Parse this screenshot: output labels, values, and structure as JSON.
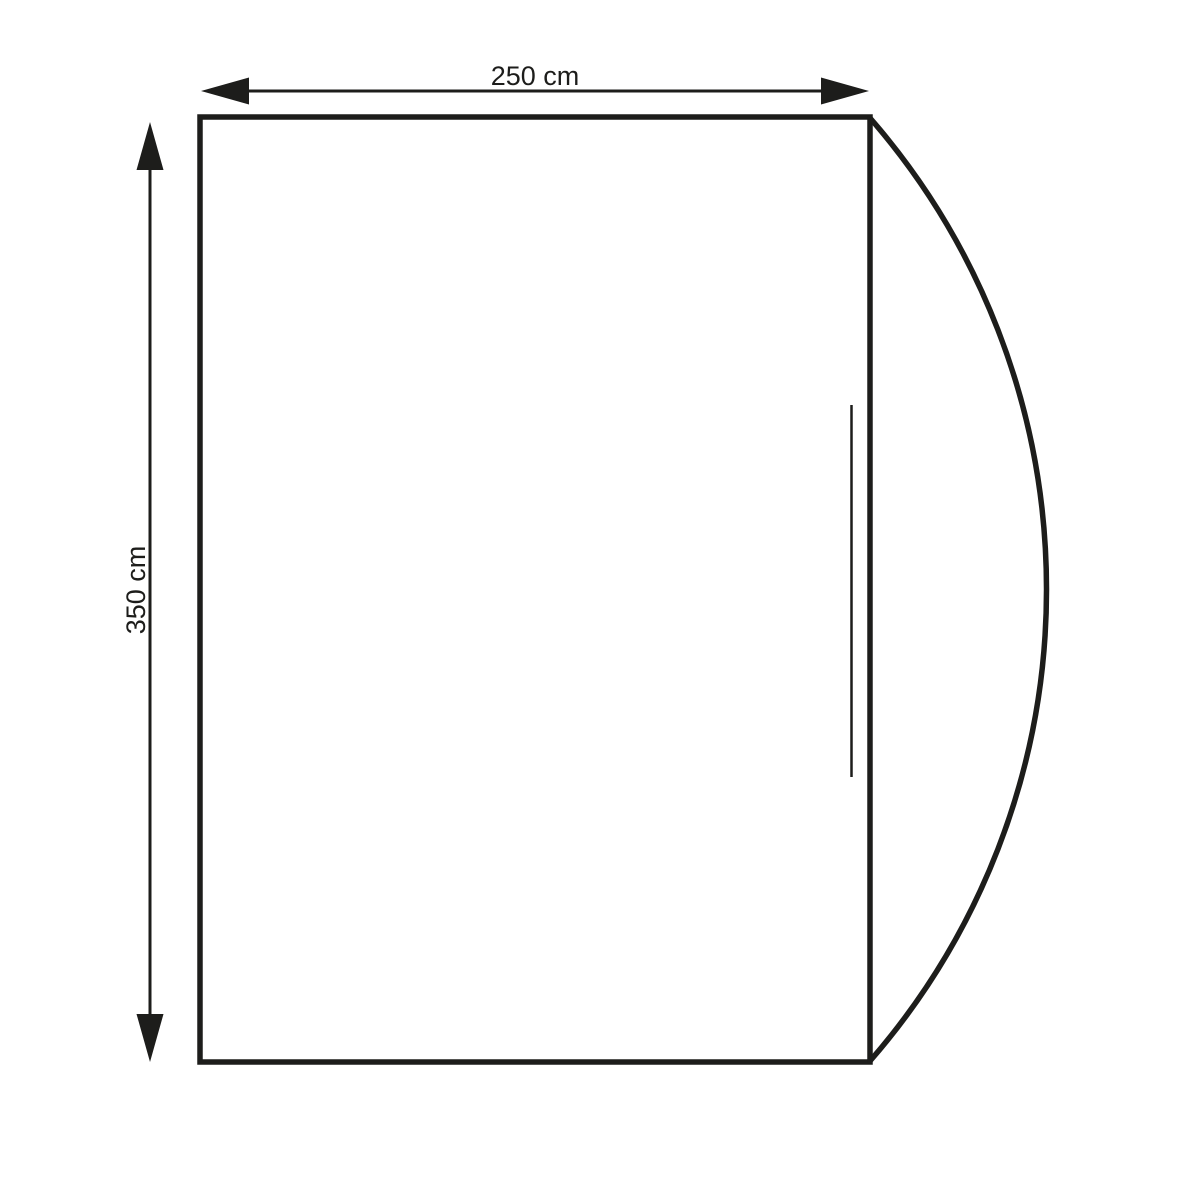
{
  "diagram": {
    "type": "technical-dimension-drawing",
    "width_dimension": {
      "label": "250 cm"
    },
    "height_dimension": {
      "label": "350 cm"
    },
    "colors": {
      "line": "#1d1d1b",
      "background": "#ffffff"
    },
    "icons": {
      "arrow_left": "filled-triangle-left",
      "arrow_right": "filled-triangle-right",
      "arrow_up": "filled-triangle-up",
      "arrow_down": "filled-triangle-down"
    }
  }
}
